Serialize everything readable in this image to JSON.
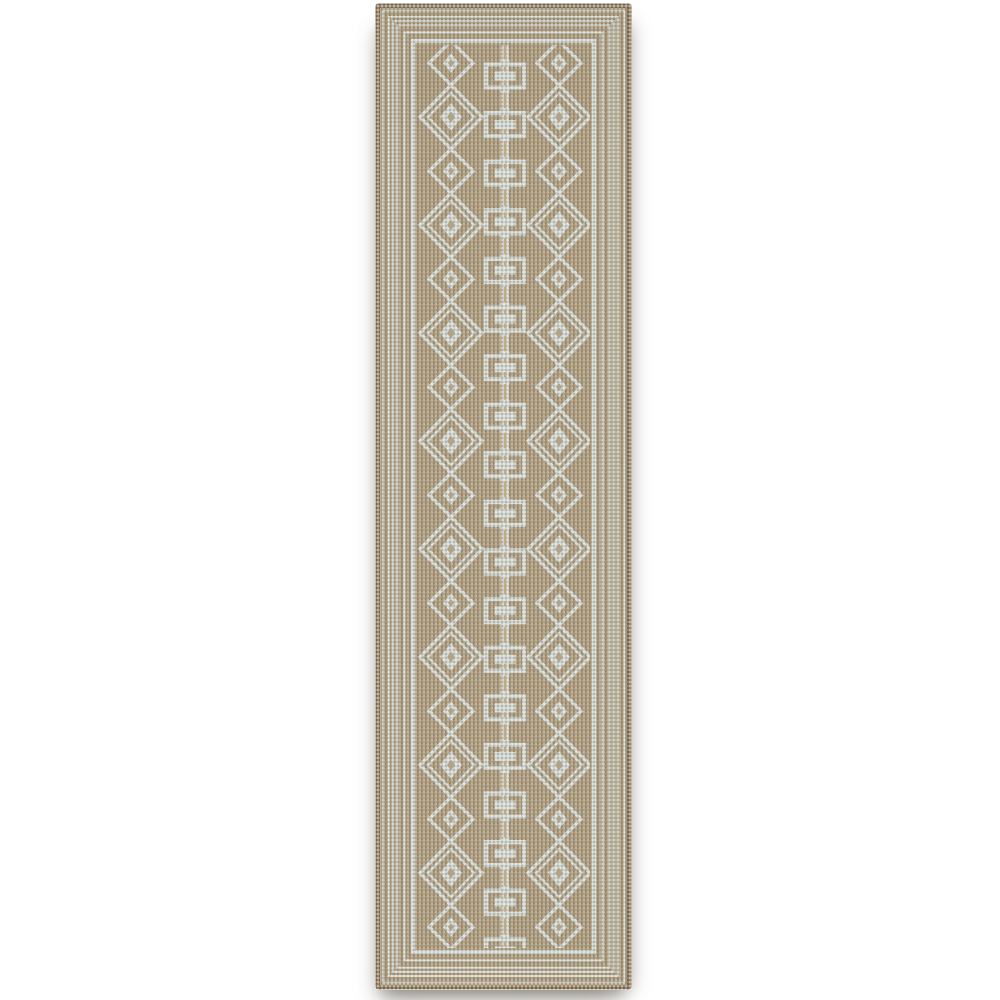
{
  "image": {
    "description": "Product photo of a beige and light-gray geometric runner rug on a white background",
    "background_color": "#ffffff"
  },
  "rug": {
    "x": 375,
    "y": 3,
    "width": 257,
    "height": 987,
    "corner_radius": 3,
    "colors": {
      "base": "#b2a285",
      "base_light": "#c7b79a",
      "base_dark": "#9c8b6f",
      "fleck_dark": "#857459",
      "motif": "#d4d9d5",
      "motif_light": "#eaede9",
      "motif_dark": "#b2bab5",
      "edge": "#93826a",
      "edge_dark": "#6b5c46",
      "edge_light": "#c3b497",
      "center_line": "#c2ab80",
      "grain_brown": "0 0 0 0 0.32  0 0 0 0 0.27  0 0 0 0 0.20  0 0 0 0.6 0",
      "grain_light": "0 0 0 0 0.93  0 0 0 0 0.94  0 0 0 0 0.90  0 0 0 0.35 0",
      "cloth_matrix": "0 0 0 0 0.30  0 0 0 0 0.25  0 0 0 0 0.18  0 0 0 0.5 0"
    },
    "border": {
      "edge_inset": 2.5,
      "edge_width": 5,
      "lines": [
        {
          "inset": 7.5,
          "width": 1.7
        },
        {
          "inset": 14,
          "width": 1.9
        },
        {
          "inset": 18.2,
          "width": 1.9
        },
        {
          "inset": 22.4,
          "width": 1.9
        },
        {
          "inset": 29.5,
          "width": 2.1
        },
        {
          "inset": 38,
          "width": 4.2
        }
      ],
      "field_inset": 44
    },
    "field": {
      "left_column_x": 76,
      "right_column_x": 184,
      "center_x": 130,
      "diamonds": {
        "start_y": 60,
        "step": 54,
        "count": 17,
        "outline_width": 3.4,
        "inner_outline_width": 2.4,
        "big": {
          "rx": 31,
          "ry": 32,
          "inner_rx": 23,
          "inner_ry": 24,
          "eye_rx": 11,
          "eye_ry": 14,
          "hole_rx": 4,
          "hole_ry": 5.5
        },
        "small": {
          "rx": 22,
          "ry": 22,
          "eye_rx": 8,
          "eye_ry": 10,
          "hole_rx": 3,
          "hole_ry": 4
        }
      },
      "chain": {
        "start_y": 73,
        "step": 48.6,
        "count": 19,
        "rect_w": 38,
        "rect_h": 23,
        "rect_stroke": 4.2,
        "bar_w": 21,
        "bar_h": 9,
        "tab_w": 9,
        "tab_h": 5,
        "rail_w": 7.5,
        "core_w": 2.6
      }
    }
  }
}
